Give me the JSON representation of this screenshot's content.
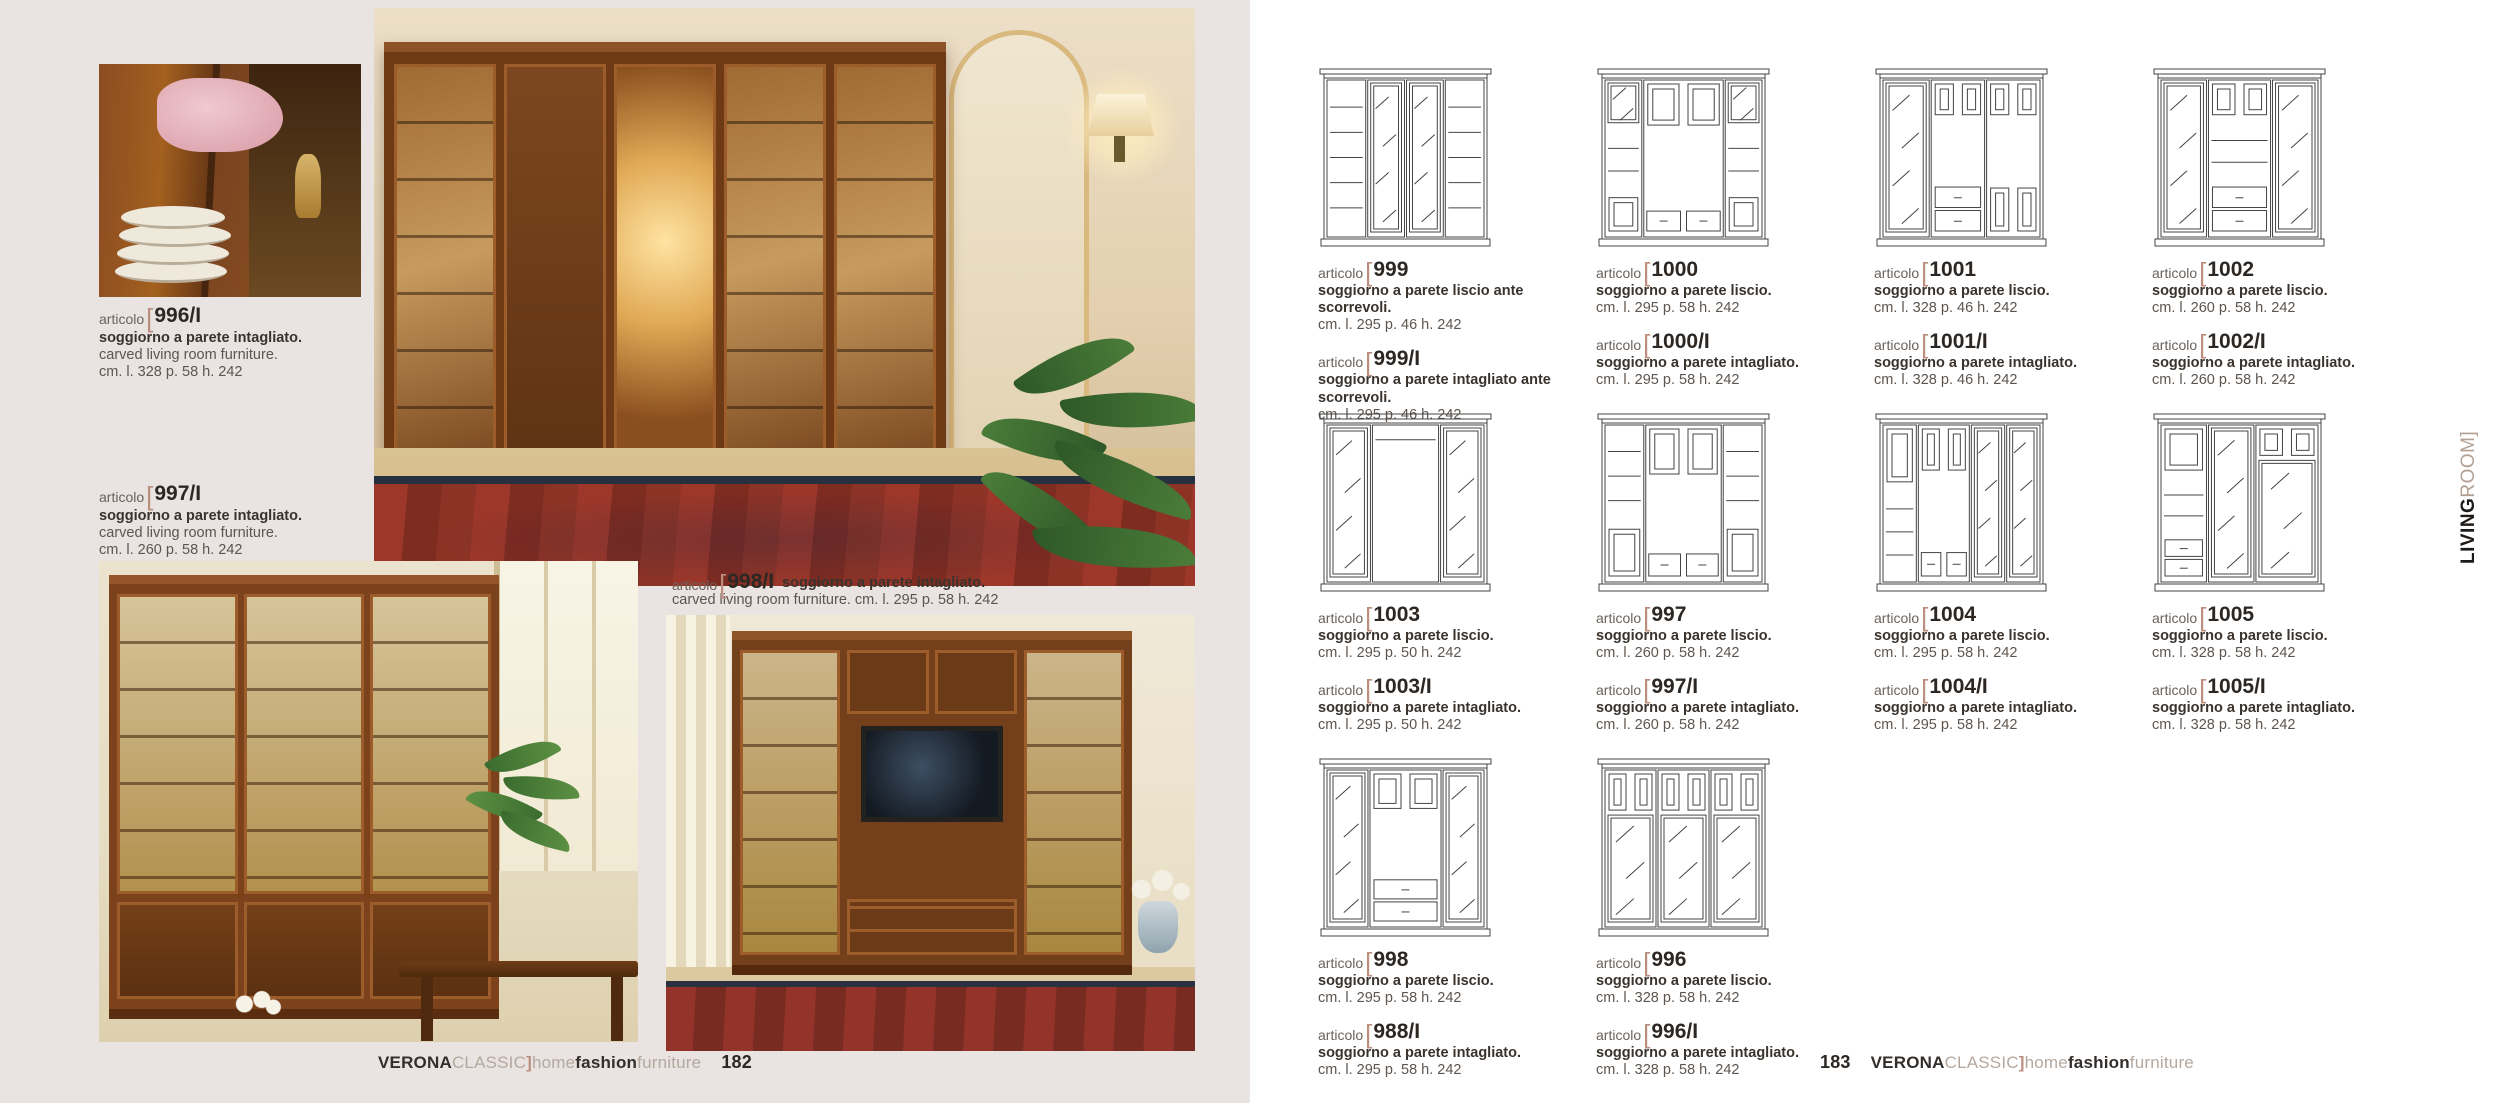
{
  "shared": {
    "articolo_label": "articolo",
    "bracket_open": "[",
    "bracket_close": "]"
  },
  "colors": {
    "accent_bracket": "#bb8e7d",
    "taupe": "#b5a89f",
    "ink": "#332e2b",
    "left_page_bg": "#e9e3e1",
    "right_page_bg": "#ffffff",
    "drawing_stroke": "#444444",
    "rug_red": "#8c3326"
  },
  "brand": {
    "parts": [
      {
        "text": "VERONA",
        "tone": "dark"
      },
      {
        "text": "CLASSIC",
        "tone": "taupe"
      },
      {
        "text": "]",
        "tone": "accent"
      },
      {
        "text": "home",
        "tone": "taupe"
      },
      {
        "text": "fashion",
        "tone": "dark"
      },
      {
        "text": "furniture",
        "tone": "taupe"
      }
    ]
  },
  "left_page": {
    "page_number": "182",
    "products": [
      {
        "number": "996/I",
        "desc_it": "soggiorno a parete intagliato.",
        "desc_en": "carved living room furniture.",
        "dims": "cm. l. 328 p. 58 h. 242"
      },
      {
        "number": "997/I",
        "desc_it": "soggiorno a parete intagliato.",
        "desc_en": "carved living room furniture.",
        "dims": "cm. l. 260 p. 58 h. 242"
      },
      {
        "number": "998/I",
        "desc_it": "soggiorno a parete intagliato.",
        "line2": "carved living room furniture. cm. l. 295 p. 58 h. 242"
      }
    ]
  },
  "right_page": {
    "page_number": "183",
    "side_label": {
      "part1": "LIVING",
      "part2": "ROOM",
      "bracket": "]"
    },
    "products": [
      {
        "drawing": {
          "cols": [
            {
              "w": 1.05,
              "cells": [
                [
                  "shelves",
                  1
                ]
              ]
            },
            {
              "w": 1,
              "cells": [
                [
                  "glass",
                  1
                ]
              ]
            },
            {
              "w": 1,
              "cells": [
                [
                  "glass",
                  1
                ]
              ]
            },
            {
              "w": 1.05,
              "cells": [
                [
                  "shelves",
                  1
                ]
              ]
            }
          ]
        },
        "entries": [
          {
            "number": "999",
            "desc": "soggiorno a parete liscio ante scorrevoli.",
            "dims": "cm. l. 295 p. 46 h. 242"
          },
          {
            "number": "999/I",
            "desc": "soggiorno a parete intagliato ante scorrevoli.",
            "dims": "cm. l. 295 p. 46 h. 242"
          }
        ]
      },
      {
        "drawing": {
          "cols": [
            {
              "w": 1,
              "cells": [
                [
                  "glass",
                  1
                ],
                [
                  "shelves",
                  1.6
                ],
                [
                  "panel",
                  0.9
                ]
              ]
            },
            {
              "w": 2.1,
              "cells": [
                [
                  "panels2",
                  1
                ],
                [
                  "open",
                  1.7
                ],
                [
                  "drawers2",
                  0.55
                ]
              ]
            },
            {
              "w": 1,
              "cells": [
                [
                  "glass",
                  1
                ],
                [
                  "shelves",
                  1.6
                ],
                [
                  "panel",
                  0.9
                ]
              ]
            }
          ]
        },
        "entries": [
          {
            "number": "1000",
            "desc": "soggiorno a parete liscio.",
            "dims": "cm. l. 295 p. 58 h. 242"
          },
          {
            "number": "1000/I",
            "desc": "soggiorno a parete intagliato.",
            "dims": "cm. l. 295 p. 58 h. 242"
          }
        ]
      },
      {
        "drawing": {
          "cols": [
            {
              "w": 1,
              "cells": [
                [
                  "glass",
                  1
                ]
              ]
            },
            {
              "w": 1.15,
              "cells": [
                [
                  "panels2",
                  0.6
                ],
                [
                  "open",
                  1.1
                ],
                [
                  "drawerstack",
                  0.8
                ]
              ]
            },
            {
              "w": 1.15,
              "cells": [
                [
                  "panels2",
                  0.6
                ],
                [
                  "open",
                  1.1
                ],
                [
                  "panels2",
                  0.8
                ]
              ]
            }
          ]
        },
        "entries": [
          {
            "number": "1001",
            "desc": "soggiorno a parete liscio.",
            "dims": "cm. l. 328 p. 46 h. 242"
          },
          {
            "number": "1001/I",
            "desc": "soggiorno a parete intagliato.",
            "dims": "cm. l. 328 p. 46 h. 242"
          }
        ]
      },
      {
        "drawing": {
          "cols": [
            {
              "w": 1,
              "cells": [
                [
                  "glass",
                  1
                ]
              ]
            },
            {
              "w": 1.35,
              "cells": [
                [
                  "panels2",
                  0.6
                ],
                [
                  "shelves",
                  1.1
                ],
                [
                  "drawerstack",
                  0.8
                ]
              ]
            },
            {
              "w": 1,
              "cells": [
                [
                  "glass",
                  1
                ]
              ]
            }
          ]
        },
        "entries": [
          {
            "number": "1002",
            "desc": "soggiorno a parete liscio.",
            "dims": "cm. l. 260 p. 58 h. 242"
          },
          {
            "number": "1002/I",
            "desc": "soggiorno a parete intagliato.",
            "dims": "cm. l. 260 p. 58 h. 242"
          }
        ]
      },
      {
        "drawing": {
          "cols": [
            {
              "w": 1,
              "cells": [
                [
                  "glass",
                  1
                ]
              ]
            },
            {
              "w": 1.5,
              "cells": [
                [
                  "shelves",
                  0.45
                ],
                [
                  "open",
                  2.05
                ]
              ]
            },
            {
              "w": 1,
              "cells": [
                [
                  "glass",
                  1
                ]
              ]
            }
          ]
        },
        "entries": [
          {
            "number": "1003",
            "desc": "soggiorno a parete liscio.",
            "dims": "cm. l. 295 p. 50 h. 242"
          },
          {
            "number": "1003/I",
            "desc": "soggiorno a parete intagliato.",
            "dims": "cm. l. 295 p. 50 h. 242"
          }
        ]
      },
      {
        "drawing": {
          "cols": [
            {
              "w": 1,
              "cells": [
                [
                  "shelves",
                  1.9
                ],
                [
                  "panel",
                  1
                ]
              ]
            },
            {
              "w": 1.9,
              "cells": [
                [
                  "panels2",
                  1
                ],
                [
                  "open",
                  1.45
                ],
                [
                  "drawers2",
                  0.55
                ]
              ]
            },
            {
              "w": 1,
              "cells": [
                [
                  "shelves",
                  1.9
                ],
                [
                  "panel",
                  1
                ]
              ]
            }
          ]
        },
        "entries": [
          {
            "number": "997",
            "desc": "soggiorno a parete liscio.",
            "dims": "cm. l. 260 p. 58 h. 242"
          },
          {
            "number": "997/I",
            "desc": "soggiorno a parete intagliato.",
            "dims": "cm. l. 260 p. 58 h. 242"
          }
        ]
      },
      {
        "drawing": {
          "cols": [
            {
              "w": 1,
              "cells": [
                [
                  "panel",
                  1
                ],
                [
                  "shelves",
                  1.6
                ]
              ]
            },
            {
              "w": 1.5,
              "cells": [
                [
                  "panels2",
                  0.8
                ],
                [
                  "open",
                  1.3
                ],
                [
                  "drawers2",
                  0.5
                ]
              ]
            },
            {
              "w": 1,
              "cells": [
                [
                  "glass",
                  1
                ]
              ]
            },
            {
              "w": 1,
              "cells": [
                [
                  "glass",
                  1
                ]
              ]
            }
          ]
        },
        "entries": [
          {
            "number": "1004",
            "desc": "soggiorno a parete liscio.",
            "dims": "cm. l. 295 p. 58 h. 242"
          },
          {
            "number": "1004/I",
            "desc": "soggiorno a parete intagliato.",
            "dims": "cm. l. 295 p. 58 h. 242"
          }
        ]
      },
      {
        "drawing": {
          "cols": [
            {
              "w": 1,
              "cells": [
                [
                  "panel",
                  0.8
                ],
                [
                  "shelves",
                  1.1
                ],
                [
                  "drawerstack",
                  0.7
                ]
              ]
            },
            {
              "w": 1,
              "cells": [
                [
                  "glass",
                  1
                ]
              ]
            },
            {
              "w": 1.35,
              "cells": [
                [
                  "panels2",
                  0.55
                ],
                [
                  "glass",
                  2.05
                ]
              ]
            }
          ]
        },
        "entries": [
          {
            "number": "1005",
            "desc": "soggiorno a parete liscio.",
            "dims": "cm. l. 328 p. 58 h. 242"
          },
          {
            "number": "1005/I",
            "desc": "soggiorno a parete intagliato.",
            "dims": "cm. l. 328 p. 58 h. 242"
          }
        ]
      },
      {
        "drawing": {
          "cols": [
            {
              "w": 1,
              "cells": [
                [
                  "glass",
                  1
                ]
              ]
            },
            {
              "w": 1.7,
              "cells": [
                [
                  "panels2",
                  0.7
                ],
                [
                  "open",
                  1.15
                ],
                [
                  "drawerstack",
                  0.8
                ]
              ]
            },
            {
              "w": 1,
              "cells": [
                [
                  "glass",
                  1
                ]
              ]
            }
          ]
        },
        "entries": [
          {
            "number": "998",
            "desc": "soggiorno a parete liscio.",
            "dims": "cm. l. 295 p. 58 h. 242"
          },
          {
            "number": "988/I",
            "desc": "soggiorno a parete intagliato.",
            "dims": "cm. l. 295 p. 58 h. 242"
          }
        ]
      },
      {
        "drawing": {
          "cols": [
            {
              "w": 1,
              "cells": [
                [
                  "panels2",
                  0.55
                ],
                [
                  "glass",
                  1.45
                ]
              ]
            },
            {
              "w": 1,
              "cells": [
                [
                  "panels2",
                  0.55
                ],
                [
                  "glass",
                  1.45
                ]
              ]
            },
            {
              "w": 1,
              "cells": [
                [
                  "panels2",
                  0.55
                ],
                [
                  "glass",
                  1.45
                ]
              ]
            }
          ]
        },
        "entries": [
          {
            "number": "996",
            "desc": "soggiorno a parete liscio.",
            "dims": "cm. l. 328 p. 58 h. 242"
          },
          {
            "number": "996/I",
            "desc": "soggiorno a parete intagliato.",
            "dims": "cm. l. 328 p. 58 h. 242"
          }
        ]
      }
    ]
  }
}
